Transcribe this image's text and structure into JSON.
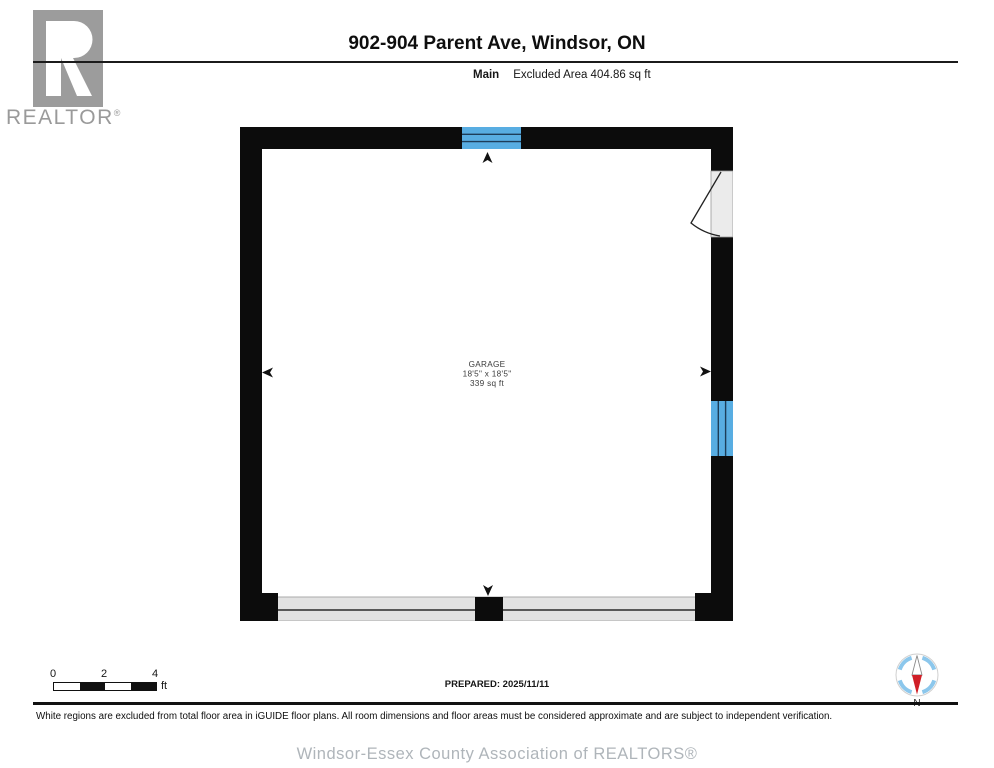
{
  "page": {
    "title": "902-904 Parent Ave, Windsor, ON"
  },
  "header": {
    "floor_label": "Main",
    "excluded_area_label": "Excluded Area 404.86 sq ft"
  },
  "logo": {
    "wordmark": "REALTOR",
    "registered_mark": "®"
  },
  "floorplan": {
    "room": {
      "name": "GARAGE",
      "dimensions": "18'5\" x 18'5\"",
      "area": "339 sq ft"
    },
    "colors": {
      "wall": "#0c0c0c",
      "window_fill": "#58ade2",
      "window_pane_line": "#1d3d59",
      "door_opening_fill": "#ebebeb",
      "garage_door_fill": "#e2e2e2"
    }
  },
  "scale_bar": {
    "ticks": [
      "0",
      "2",
      "4"
    ],
    "unit": "ft"
  },
  "prepared_label": "PREPARED: 2025/11/11",
  "compass": {
    "north_label": "N"
  },
  "disclaimer": "White regions are excluded from total floor area in iGUIDE floor plans. All room dimensions and floor areas must be considered approximate and are subject to independent verification.",
  "footer": "Windsor-Essex County Association of REALTORS®"
}
